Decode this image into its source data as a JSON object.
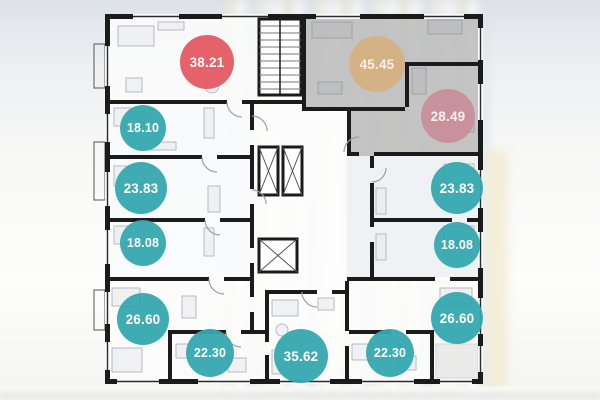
{
  "floor_plan": {
    "badges": [
      {
        "value": "38.21",
        "variant": "red"
      },
      {
        "value": "45.45",
        "variant": "tan"
      },
      {
        "value": "28.49",
        "variant": "pink"
      },
      {
        "value": "18.10",
        "variant": "teal"
      },
      {
        "value": "23.83",
        "variant": "teal"
      },
      {
        "value": "18.08",
        "variant": "teal"
      },
      {
        "value": "26.60",
        "variant": "teal"
      },
      {
        "value": "22.30",
        "variant": "teal"
      },
      {
        "value": "35.62",
        "variant": "teal"
      },
      {
        "value": "22.30",
        "variant": "teal"
      },
      {
        "value": "23.83",
        "variant": "teal"
      },
      {
        "value": "18.08",
        "variant": "teal"
      },
      {
        "value": "26.60",
        "variant": "teal"
      }
    ],
    "colors": {
      "badge_teal": "#35a8b0",
      "badge_red": "#e45c64",
      "badge_tan": "#d5b283",
      "badge_pink": "#c98f9a",
      "wall": "#1b1b1b",
      "selected_overlay_gray": "#8f8f8f",
      "floor_white": "#fbfbfb",
      "floor_blue_tint": "#e9eff3"
    }
  }
}
